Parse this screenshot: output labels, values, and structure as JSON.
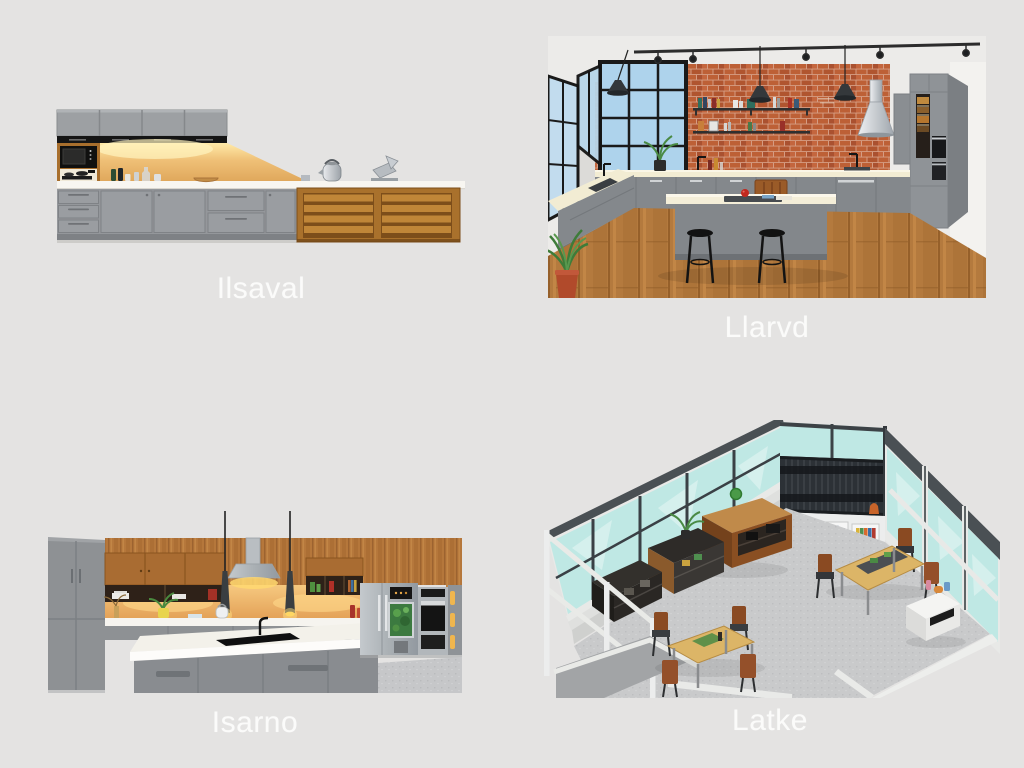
{
  "gallery": {
    "panels": [
      {
        "label": "Ilsaval"
      },
      {
        "label": "Llarvd"
      },
      {
        "label": "Isarno"
      },
      {
        "label": "Latke"
      }
    ]
  },
  "palette": {
    "page_background": "#e4e3e2",
    "caption_text": "#fbfbfa",
    "cabinet_gray": "#94979b",
    "counter_white": "#f7f5f0",
    "backsplash_amber": "#e8b768",
    "wood_brown": "#a9712c",
    "brick_red": "#b95f3a",
    "wood_floor": "#b47a3e",
    "glass_aqua": "#bfe8e4",
    "floor_gray": "#c9cacb",
    "frame_dark": "#4a5054"
  }
}
